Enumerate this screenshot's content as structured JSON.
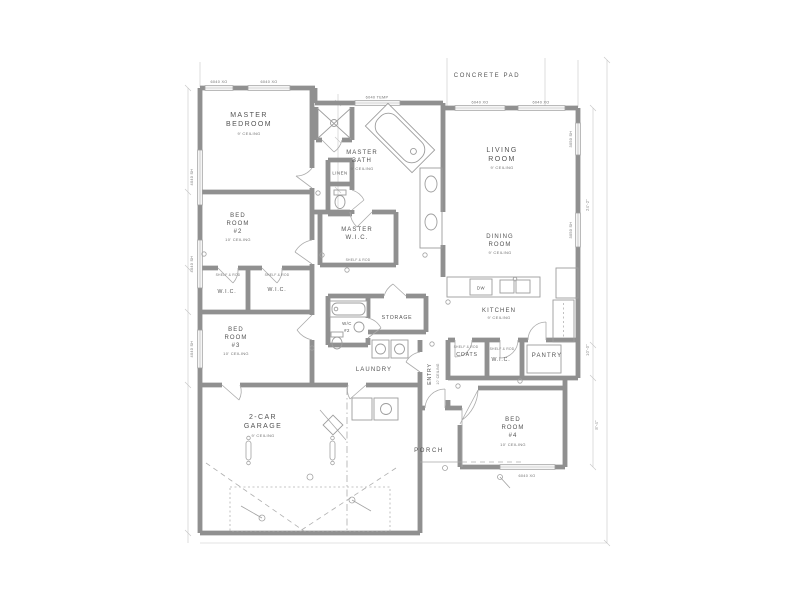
{
  "site": {
    "concrete_pad": "CONCRETE PAD"
  },
  "rooms": {
    "master_bedroom": {
      "l1": "MASTER",
      "l2": "BEDROOM",
      "clg": "9' CEILING"
    },
    "master_bath": {
      "l1": "MASTER",
      "l2": "BATH",
      "clg": "9' CEILING"
    },
    "master_wic": {
      "l1": "MASTER",
      "l2": "W.I.C."
    },
    "linen": {
      "l1": "LINEN"
    },
    "bed2": {
      "l1": "BED",
      "l2": "ROOM",
      "l3": "#2",
      "clg": "10' CEILING"
    },
    "bed3": {
      "l1": "BED",
      "l2": "ROOM",
      "l3": "#3",
      "clg": "10' CEILING"
    },
    "bed4": {
      "l1": "BED",
      "l2": "ROOM",
      "l3": "#4",
      "clg": "10' CEILING"
    },
    "wic_a": {
      "l1": "W.I.C."
    },
    "wic_b": {
      "l1": "W.I.C."
    },
    "wc2": {
      "l1": "W/C",
      "l2": "#2"
    },
    "storage": {
      "l1": "STORAGE"
    },
    "laundry": {
      "l1": "LAUNDRY"
    },
    "entry": {
      "l1": "ENTRY",
      "clg": "10' CEILING"
    },
    "living": {
      "l1": "LIVING",
      "l2": "ROOM",
      "clg": "9' CEILING"
    },
    "dining": {
      "l1": "DINING",
      "l2": "ROOM",
      "clg": "9' CEILING"
    },
    "kitchen": {
      "l1": "KITCHEN",
      "clg": "9' CEILING"
    },
    "coats": {
      "l1": "COATS"
    },
    "wic_hall": {
      "l1": "W.I.C."
    },
    "pantry": {
      "l1": "PANTRY"
    },
    "porch": {
      "l1": "PORCH"
    },
    "garage": {
      "l1": "2-CAR",
      "l2": "GARAGE",
      "clg": "9' CEILING"
    }
  },
  "notes": {
    "shelf_rod": "SHELF & ROD",
    "dw": "DW"
  },
  "window_labels": {
    "xo6040": "6040 XO",
    "temp6040": "6040 TEMP",
    "sh4040": "4040 SH",
    "sh3050": "3050 SH"
  },
  "dimensions": [
    "24'-2\"",
    "10'-0\"",
    "8'-4\""
  ],
  "colors": {
    "wall": "#8d8d8d",
    "line": "#9a9a9a",
    "dim": "#c6c6c6",
    "text": "#4e4e4e",
    "bg": "#ffffff"
  }
}
